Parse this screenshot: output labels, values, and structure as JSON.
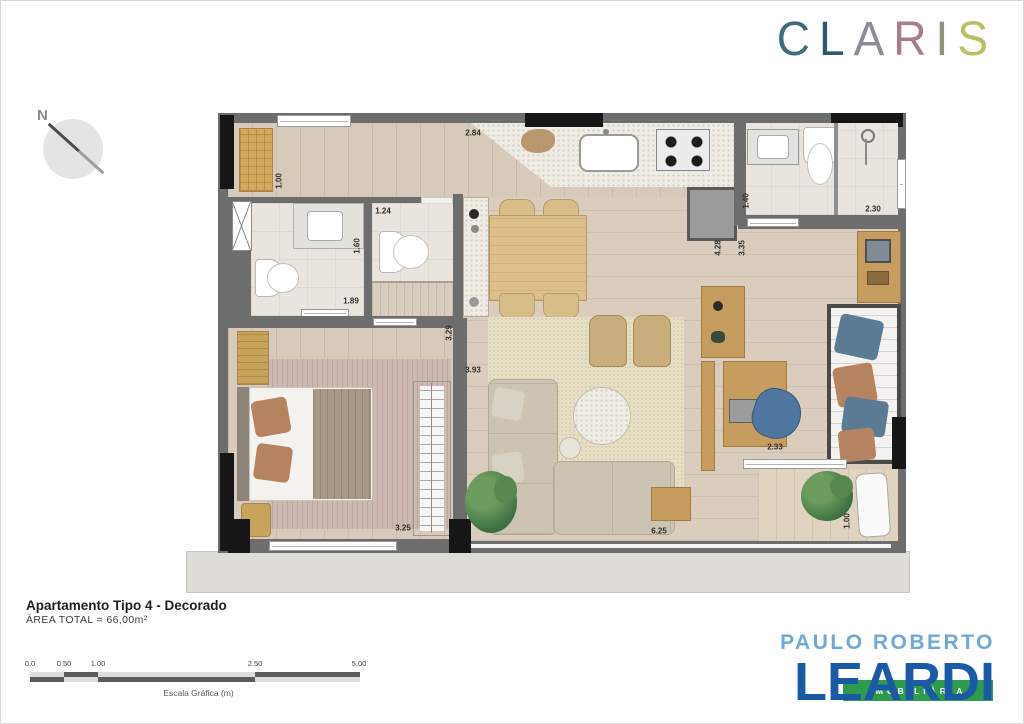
{
  "claris_logo": {
    "letters": [
      {
        "ch": "C",
        "color": "#3f6d7c"
      },
      {
        "ch": "L",
        "color": "#30596f"
      },
      {
        "ch": "A",
        "color": "#8a8d98"
      },
      {
        "ch": "R",
        "color": "#a77c8c"
      },
      {
        "ch": "I",
        "color": "#8e9077"
      },
      {
        "ch": "S",
        "color": "#b9bd63"
      }
    ]
  },
  "compass": {
    "label": "N"
  },
  "plan": {
    "dimensions": [
      {
        "text": "1.00",
        "x": 278,
        "y": 180,
        "v": 1
      },
      {
        "text": "2.84",
        "x": 472,
        "y": 132,
        "v": 0
      },
      {
        "text": "1.40",
        "x": 745,
        "y": 200,
        "v": 1
      },
      {
        "text": "2.30",
        "x": 872,
        "y": 208,
        "v": 0
      },
      {
        "text": "1.24",
        "x": 382,
        "y": 210,
        "v": 0
      },
      {
        "text": "1.60",
        "x": 356,
        "y": 245,
        "v": 1
      },
      {
        "text": "1.89",
        "x": 350,
        "y": 300,
        "v": 0
      },
      {
        "text": "3.29",
        "x": 448,
        "y": 332,
        "v": 1
      },
      {
        "text": "3.93",
        "x": 472,
        "y": 369,
        "v": 0
      },
      {
        "text": "4.28",
        "x": 717,
        "y": 247,
        "v": 1
      },
      {
        "text": "3.35",
        "x": 741,
        "y": 247,
        "v": 1
      },
      {
        "text": "2.33",
        "x": 774,
        "y": 446,
        "v": 0
      },
      {
        "text": "3.25",
        "x": 402,
        "y": 527,
        "v": 0
      },
      {
        "text": "6.25",
        "x": 658,
        "y": 530,
        "v": 0
      },
      {
        "text": "1.00",
        "x": 846,
        "y": 520,
        "v": 1
      }
    ],
    "colors": {
      "wall": "#6d6d6d",
      "wood": "#d7cabb",
      "tile": "#e9e5de",
      "terrace": "#dddcd6"
    }
  },
  "footer": {
    "title": "Apartamento Tipo 4 - Decorado",
    "area": "ÁREA TOTAL = 66,00m²"
  },
  "scalebar": {
    "labels": [
      {
        "text": "0.0",
        "x": 4
      },
      {
        "text": "0.50",
        "x": 38
      },
      {
        "text": "1.00",
        "x": 72
      },
      {
        "text": "2.50",
        "x": 229
      },
      {
        "text": "5.00",
        "x": 333
      }
    ],
    "caption": "Escala Gráfica (m)"
  },
  "leardi_logo": {
    "top": "PAULO ROBERTO",
    "main": "LEARDI",
    "banner": "IMOBILIÁRIA",
    "colors": {
      "top": "#6fa9d9",
      "main": "#1a5aa5",
      "banner_bg": "#2e9c4c"
    }
  }
}
